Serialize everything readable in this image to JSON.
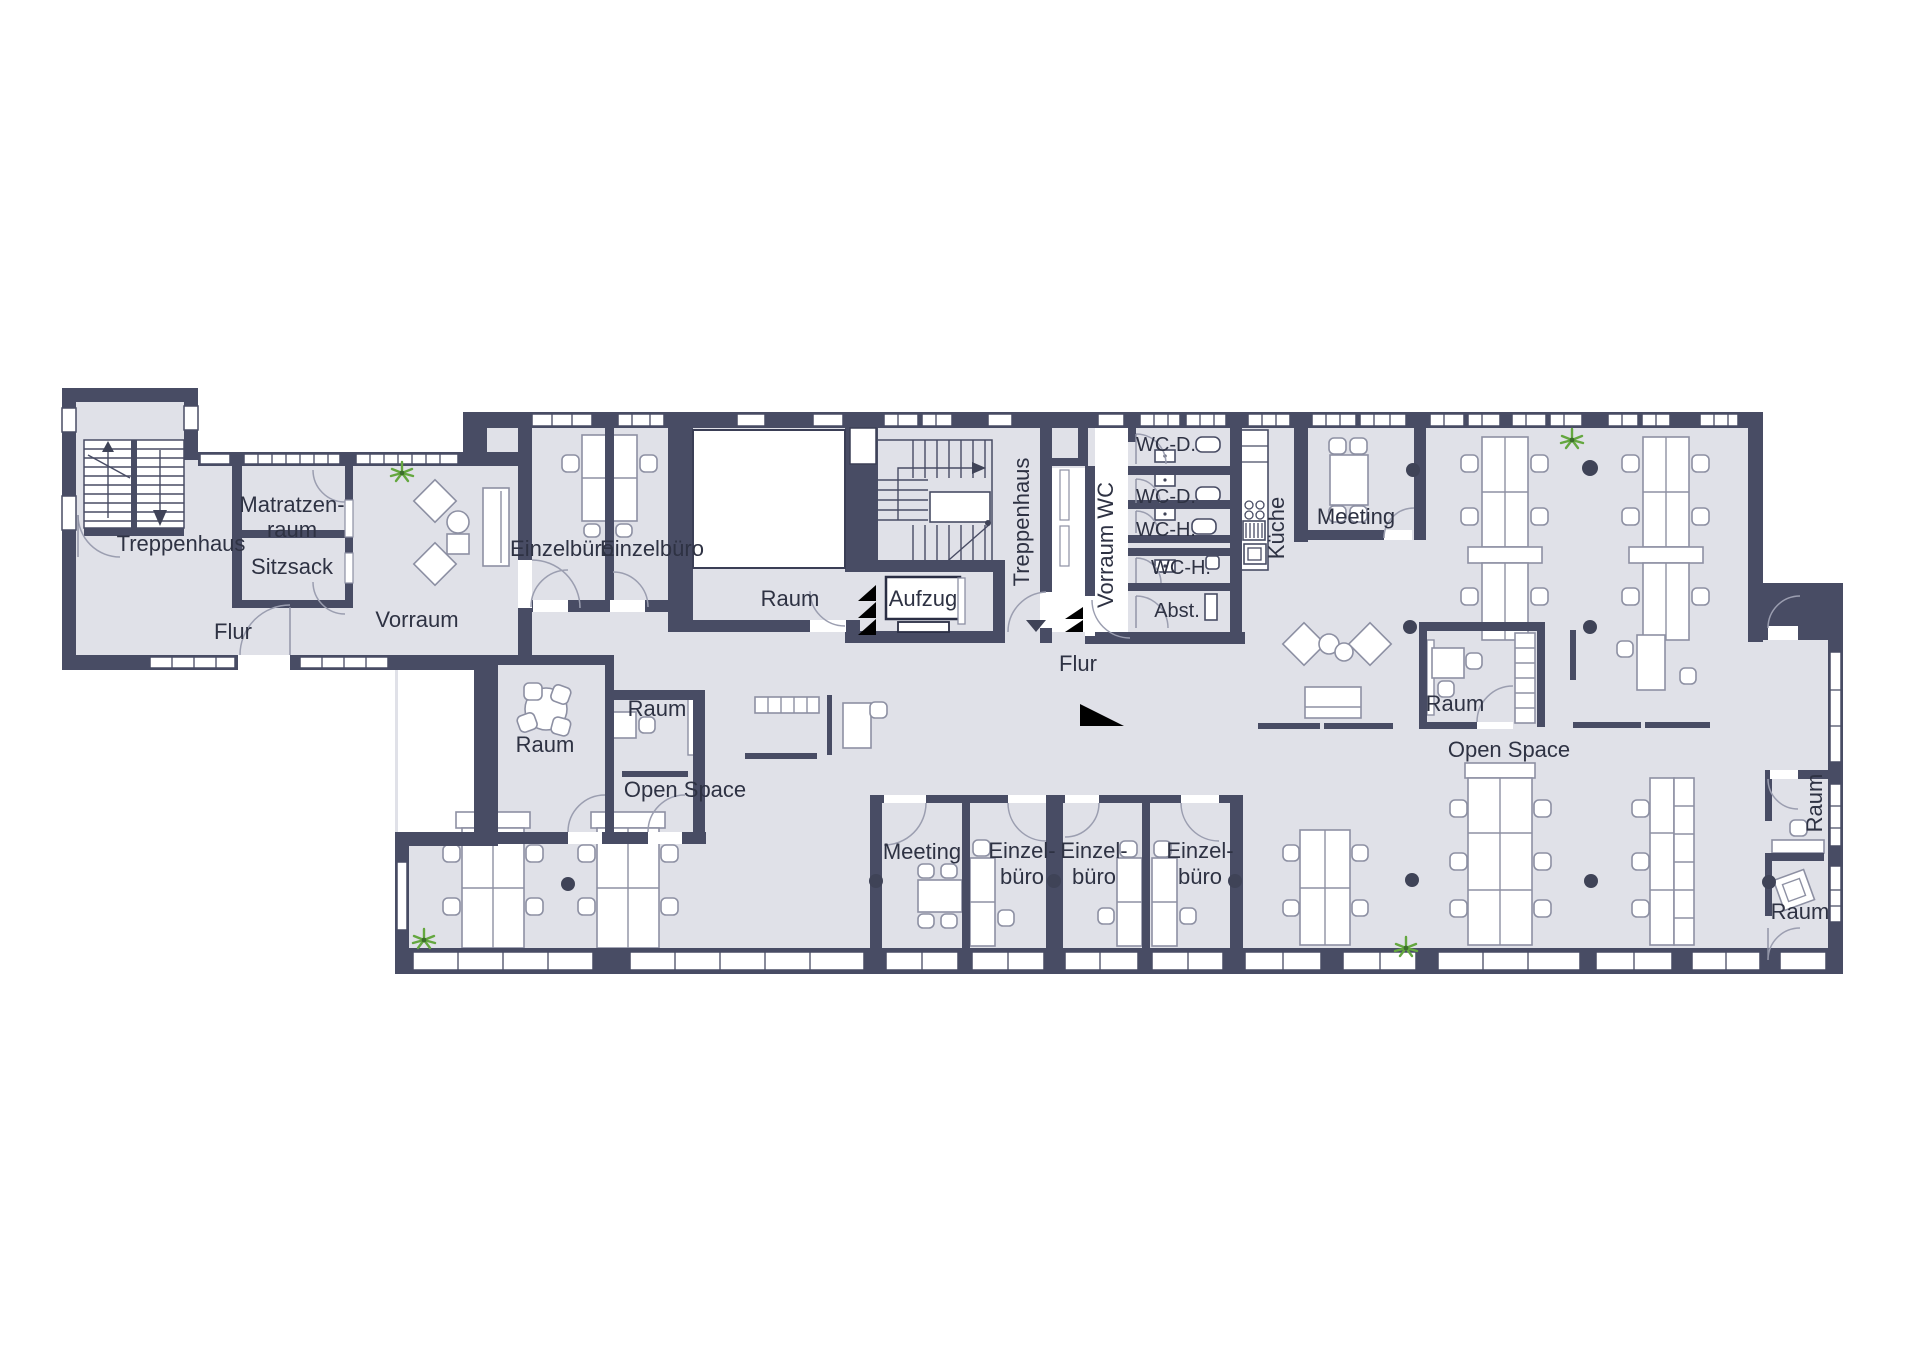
{
  "floor_plan": {
    "background": "#ffffff",
    "wall_color": "#484c64",
    "floor_color": "#e0e1e8",
    "plant_green": "#64a73f",
    "label_color": "#2e3243"
  },
  "labels": {
    "left_wing": {
      "treppenhaus": "Treppenhaus",
      "matratzenraum_line1": "Matratzen-",
      "matratzenraum_line2": "raum",
      "sitzsack": "Sitzsack",
      "flur": "Flur",
      "vorraum": "Vorraum"
    },
    "offices_top": {
      "einzelbuero_1": "Einzelbüro",
      "einzelbuero_2": "Einzelbüro"
    },
    "center": {
      "raum": "Raum",
      "aufzug": "Aufzug",
      "treppenhaus": "Treppenhaus",
      "flur": "Flur"
    },
    "wc_block": {
      "vorraum_wc": "Vorraum WC",
      "wc_d_1": "WC-D.",
      "wc_d_2": "WC-D.",
      "wc_h_1": "WC-H.",
      "wc_h_2": "WC-H.",
      "abstellraum": "Abst.",
      "kueche": "Küche"
    },
    "meeting_top": "Meeting",
    "open_space_left": "Open Space",
    "open_space_right": "Open Space",
    "small_rooms": {
      "raum_1": "Raum",
      "raum_2": "Raum",
      "raum_mid": "Raum"
    },
    "bottom_rooms": {
      "meeting": "Meeting",
      "einzelbuero_1_line1": "Einzel-",
      "einzelbuero_1_line2": "büro",
      "einzelbuero_2_line1": "Einzel-",
      "einzelbuero_2_line2": "büro",
      "einzelbuero_3_line1": "Einzel-",
      "einzelbuero_3_line2": "büro"
    },
    "right_wing": {
      "raum_top": "Raum",
      "raum_bottom": "Raum"
    }
  }
}
